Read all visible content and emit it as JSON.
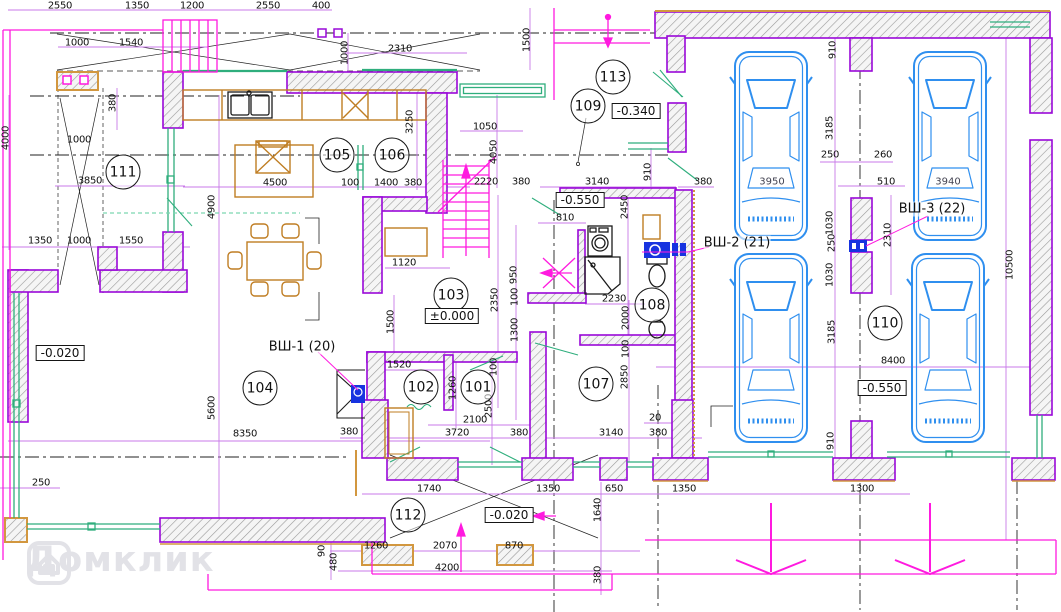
{
  "meta": {
    "type": "architectural-floor-plan",
    "language": "ru"
  },
  "watermark": {
    "text": "Домклик"
  },
  "colors": {
    "wall_outline": "#9908d8",
    "wall_hatch": "#9a9a9a",
    "orange_face": "#d2973f",
    "dimension_line": "#c87ae8",
    "magenta": "#ff1adf",
    "green_window": "#2fae7d",
    "furniture": "#bf7d22",
    "car": "#2f8fef",
    "fixture_blue": "#1733e0",
    "axis": "#222222",
    "text": "#111111",
    "watermark": "#e2e2e7"
  },
  "rooms": [
    {
      "number": "101",
      "x": 478,
      "y": 387
    },
    {
      "number": "102",
      "x": 421,
      "y": 387
    },
    {
      "number": "103",
      "x": 451,
      "y": 295
    },
    {
      "number": "104",
      "x": 260,
      "y": 388
    },
    {
      "number": "105",
      "x": 337,
      "y": 155
    },
    {
      "number": "106",
      "x": 392,
      "y": 155
    },
    {
      "number": "107",
      "x": 596,
      "y": 384
    },
    {
      "number": "108",
      "x": 652,
      "y": 305
    },
    {
      "number": "109",
      "x": 588,
      "y": 106
    },
    {
      "number": "110",
      "x": 885,
      "y": 323
    },
    {
      "number": "111",
      "x": 123,
      "y": 172
    },
    {
      "number": "112",
      "x": 408,
      "y": 515
    },
    {
      "number": "113",
      "x": 613,
      "y": 77
    }
  ],
  "elevations": [
    {
      "text": "-0.020",
      "x": 60,
      "y": 353
    },
    {
      "text": "±0.000",
      "x": 452,
      "y": 316
    },
    {
      "text": "-0.340",
      "x": 636,
      "y": 111
    },
    {
      "text": "-0.550",
      "x": 580,
      "y": 200
    },
    {
      "text": "-0.550",
      "x": 882,
      "y": 388
    },
    {
      "text": "-0.020",
      "x": 509,
      "y": 515
    }
  ],
  "shaft_labels": [
    {
      "text": "ВШ-1 (20)",
      "x": 302,
      "y": 347
    },
    {
      "text": "ВШ-2 (21)",
      "x": 737,
      "y": 243
    },
    {
      "text": "ВШ-3 (22)",
      "x": 932,
      "y": 209
    }
  ],
  "car_labels": [
    {
      "text": "3950",
      "x": 772,
      "y": 182
    },
    {
      "text": "3940",
      "x": 948,
      "y": 182
    }
  ],
  "dimensions": [
    {
      "text": "2550",
      "x": 60,
      "y": 6
    },
    {
      "text": "1350",
      "x": 137,
      "y": 6
    },
    {
      "text": "1200",
      "x": 192,
      "y": 6
    },
    {
      "text": "2550",
      "x": 268,
      "y": 6
    },
    {
      "text": "400",
      "x": 321,
      "y": 6
    },
    {
      "text": "1000",
      "x": 77,
      "y": 43
    },
    {
      "text": "1540",
      "x": 131,
      "y": 43
    },
    {
      "text": "2310",
      "x": 400,
      "y": 49
    },
    {
      "text": "1500",
      "x": 527,
      "y": 40,
      "v": true
    },
    {
      "text": "1000",
      "x": 345,
      "y": 53,
      "v": true
    },
    {
      "text": "4000",
      "x": 6,
      "y": 138,
      "v": true
    },
    {
      "text": "380",
      "x": 113,
      "y": 103,
      "v": true
    },
    {
      "text": "1000",
      "x": 79,
      "y": 140
    },
    {
      "text": "3850",
      "x": 90,
      "y": 181
    },
    {
      "text": "1350",
      "x": 40,
      "y": 241
    },
    {
      "text": "1000",
      "x": 79,
      "y": 241
    },
    {
      "text": "1550",
      "x": 131,
      "y": 241
    },
    {
      "text": "4900",
      "x": 212,
      "y": 207,
      "v": true
    },
    {
      "text": "5600",
      "x": 212,
      "y": 408,
      "v": true
    },
    {
      "text": "8350",
      "x": 245,
      "y": 434
    },
    {
      "text": "250",
      "x": 41,
      "y": 483
    },
    {
      "text": "90",
      "x": 322,
      "y": 551,
      "v": true
    },
    {
      "text": "480",
      "x": 334,
      "y": 562,
      "v": true
    },
    {
      "text": "4500",
      "x": 275,
      "y": 183
    },
    {
      "text": "100",
      "x": 350,
      "y": 183
    },
    {
      "text": "1400",
      "x": 386,
      "y": 183
    },
    {
      "text": "380",
      "x": 413,
      "y": 183
    },
    {
      "text": "3250",
      "x": 410,
      "y": 122,
      "v": true
    },
    {
      "text": "1120",
      "x": 404,
      "y": 263
    },
    {
      "text": "1500",
      "x": 391,
      "y": 322,
      "v": true
    },
    {
      "text": "1520",
      "x": 399,
      "y": 365
    },
    {
      "text": "1260",
      "x": 453,
      "y": 388,
      "v": true
    },
    {
      "text": "100",
      "x": 494,
      "y": 367,
      "v": true
    },
    {
      "text": "2500",
      "x": 489,
      "y": 406,
      "v": true
    },
    {
      "text": "2100",
      "x": 475,
      "y": 420
    },
    {
      "text": "3720",
      "x": 457,
      "y": 433
    },
    {
      "text": "380",
      "x": 349,
      "y": 432
    },
    {
      "text": "380",
      "x": 519,
      "y": 433
    },
    {
      "text": "1050",
      "x": 485,
      "y": 127
    },
    {
      "text": "4050",
      "x": 494,
      "y": 152,
      "v": true
    },
    {
      "text": "2220",
      "x": 486,
      "y": 182
    },
    {
      "text": "380",
      "x": 521,
      "y": 182
    },
    {
      "text": "2350",
      "x": 495,
      "y": 300,
      "v": true
    },
    {
      "text": "950",
      "x": 514,
      "y": 275,
      "v": true
    },
    {
      "text": "100",
      "x": 515,
      "y": 297,
      "v": true
    },
    {
      "text": "1300",
      "x": 515,
      "y": 330,
      "v": true
    },
    {
      "text": "3140",
      "x": 597,
      "y": 182
    },
    {
      "text": "910",
      "x": 648,
      "y": 172,
      "v": true
    },
    {
      "text": "810",
      "x": 565,
      "y": 218
    },
    {
      "text": "2450",
      "x": 625,
      "y": 207,
      "v": true
    },
    {
      "text": "2230",
      "x": 614,
      "y": 299
    },
    {
      "text": "2000",
      "x": 626,
      "y": 318,
      "v": true
    },
    {
      "text": "100",
      "x": 626,
      "y": 349,
      "v": true
    },
    {
      "text": "2850",
      "x": 625,
      "y": 377,
      "v": true
    },
    {
      "text": "20",
      "x": 655,
      "y": 418
    },
    {
      "text": "3140",
      "x": 611,
      "y": 433
    },
    {
      "text": "380",
      "x": 658,
      "y": 433
    },
    {
      "text": "1740",
      "x": 429,
      "y": 489
    },
    {
      "text": "1350",
      "x": 548,
      "y": 489
    },
    {
      "text": "650",
      "x": 614,
      "y": 489
    },
    {
      "text": "1640",
      "x": 598,
      "y": 510,
      "v": true
    },
    {
      "text": "380",
      "x": 598,
      "y": 575,
      "v": true
    },
    {
      "text": "1260",
      "x": 376,
      "y": 546
    },
    {
      "text": "2070",
      "x": 445,
      "y": 546
    },
    {
      "text": "870",
      "x": 514,
      "y": 546
    },
    {
      "text": "4200",
      "x": 447,
      "y": 568
    },
    {
      "text": "1350",
      "x": 684,
      "y": 489
    },
    {
      "text": "1300",
      "x": 862,
      "y": 489
    },
    {
      "text": "910",
      "x": 831,
      "y": 441,
      "v": true
    },
    {
      "text": "910",
      "x": 833,
      "y": 50,
      "v": true
    },
    {
      "text": "3185",
      "x": 830,
      "y": 128,
      "v": true
    },
    {
      "text": "250",
      "x": 830,
      "y": 155
    },
    {
      "text": "260",
      "x": 883,
      "y": 155
    },
    {
      "text": "510",
      "x": 886,
      "y": 182
    },
    {
      "text": "1030",
      "x": 830,
      "y": 223,
      "v": true
    },
    {
      "text": "250",
      "x": 832,
      "y": 243,
      "v": true
    },
    {
      "text": "1030",
      "x": 830,
      "y": 275,
      "v": true
    },
    {
      "text": "2310",
      "x": 888,
      "y": 235,
      "v": true
    },
    {
      "text": "3185",
      "x": 832,
      "y": 332,
      "v": true
    },
    {
      "text": "8400",
      "x": 893,
      "y": 361
    },
    {
      "text": "10500",
      "x": 1010,
      "y": 265,
      "v": true
    },
    {
      "text": "380",
      "x": 703,
      "y": 182
    }
  ]
}
